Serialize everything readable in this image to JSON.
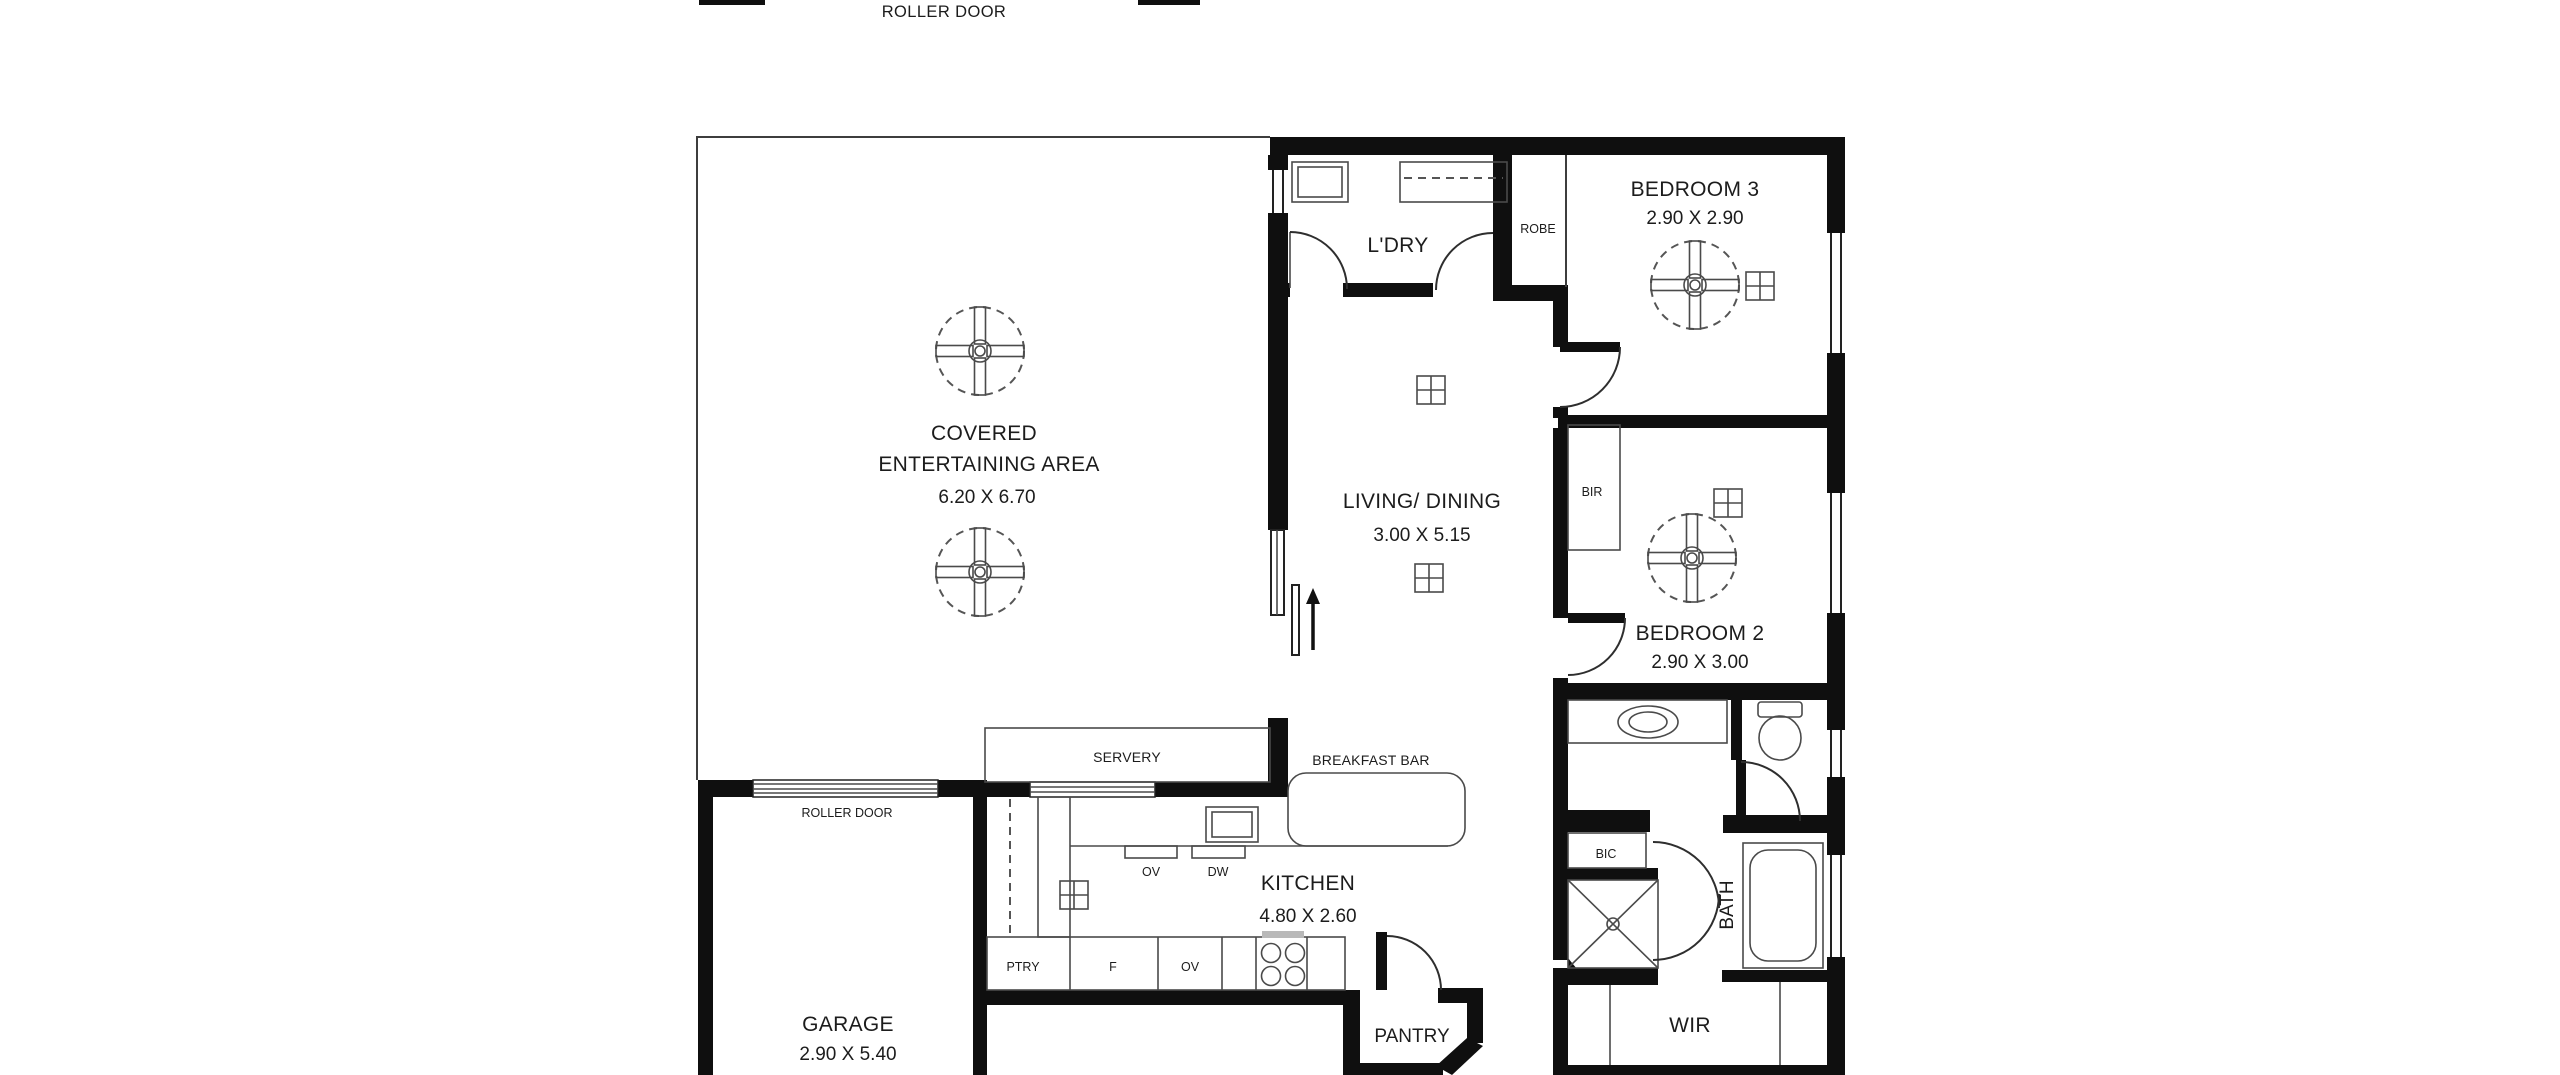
{
  "colors": {
    "wall": "#0f0f0f",
    "thin_line": "#3d3d3d",
    "text": "#1c1c1c",
    "background": "#ffffff"
  },
  "header": {
    "roller_door_top": "ROLLER DOOR"
  },
  "rooms": {
    "covered": {
      "line1": "COVERED",
      "line2": "ENTERTAINING AREA",
      "dims": "6.20 X 6.70"
    },
    "laundry": {
      "name": "L'DRY"
    },
    "robe": {
      "name": "ROBE"
    },
    "bedroom3": {
      "name": "BEDROOM 3",
      "dims": "2.90 X 2.90"
    },
    "living": {
      "name": "LIVING/ DINING",
      "dims": "3.00 X 5.15"
    },
    "bir": {
      "name": "BIR"
    },
    "bedroom2": {
      "name": "BEDROOM 2",
      "dims": "2.90 X 3.00"
    },
    "kitchen": {
      "name": "KITCHEN",
      "dims": "4.80 X 2.60"
    },
    "garage": {
      "name": "GARAGE",
      "dims": "2.90 X 5.40",
      "roller_door": "ROLLER DOOR"
    },
    "pantry": {
      "name": "PANTRY"
    },
    "bath": {
      "name": "BATH"
    },
    "wir": {
      "name": "WIR"
    },
    "bic": {
      "name": "BIC"
    }
  },
  "fixtures": {
    "servery": "SERVERY",
    "breakfast_bar": "BREAKFAST BAR",
    "oven_upper": "OV",
    "dishwasher": "DW",
    "pantry_cupboard": "PTRY",
    "fridge": "F",
    "oven_lower": "OV"
  }
}
